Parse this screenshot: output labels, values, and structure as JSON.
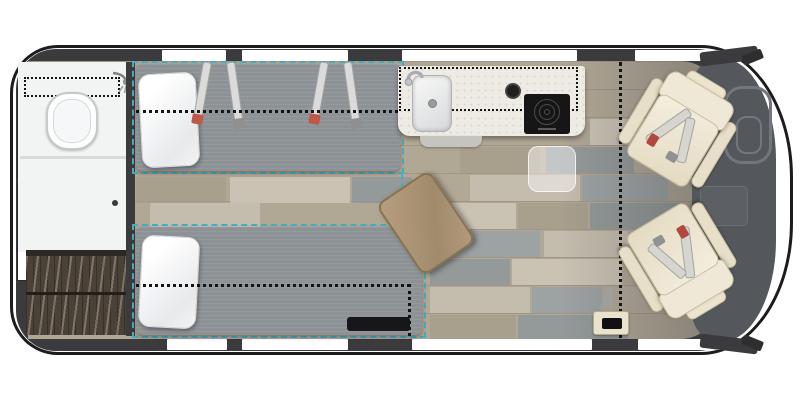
{
  "title": "Camper van floor plan - rear twin beds, wet bath, galley and swivel cab seats",
  "theme": {
    "body": "#3b3b3d",
    "outline": "#1c1c1e",
    "window": "#ffffff",
    "floor": "#b1a795",
    "bath": "#f2f3f3",
    "wardrobe": "#4a4138",
    "teal": "#45aec4",
    "dotted": "#141414",
    "mattress": "#8d9296",
    "counter": "#edebe4",
    "cooktop": "#161616",
    "dash": "#54585c",
    "chairline": "#ccc0a0"
  },
  "plan": {
    "orientation": {
      "rear": "left",
      "front": "right"
    },
    "windows": {
      "top_wall": 4,
      "bottom_wall": 4,
      "rear_doors": 2
    },
    "fixtures": [
      "rear-door-windows",
      "wet-bath",
      "toilet",
      "shower-head",
      "shower-curtain-track",
      "bath-door",
      "wardrobe",
      "twin-bed-top",
      "twin-bed-bottom",
      "pillow-top",
      "pillow-bottom",
      "bed-seat-belt-straps",
      "bed-platform-outline-teal-dashed",
      "optional-config-dotted-lines",
      "galley-counter",
      "sink",
      "faucet",
      "round-burner-knob",
      "induction-cooktop",
      "counter-step",
      "flip-up-shelf-ghost",
      "removable-wood-table",
      "table-floor-mount",
      "under-bed-heater-vent",
      "swivel-chair-upper",
      "swivel-chair-lower",
      "chair-seat-belts",
      "center-console",
      "steering-wheel",
      "dashboard",
      "side-mirrors"
    ]
  }
}
